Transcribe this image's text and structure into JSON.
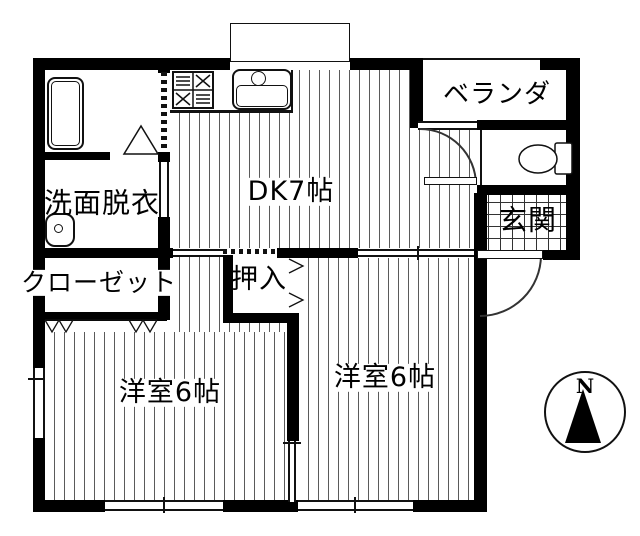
{
  "title": "2DK apartment floor plan",
  "colors": {
    "wall": "#000000",
    "line": "#333333",
    "floor_stripe": "#5a5a5a",
    "background": "#ffffff"
  },
  "rooms": {
    "dk": {
      "label": "DK7帖"
    },
    "veranda": {
      "label": "ベランダ"
    },
    "genkan": {
      "label": "玄関"
    },
    "washroom": {
      "label": "洗面脱衣"
    },
    "closet": {
      "label": "クローゼット"
    },
    "oshiire": {
      "label": "押入"
    },
    "bedroom1": {
      "label": "洋室6帖"
    },
    "bedroom2": {
      "label": "洋室6帖"
    }
  },
  "compass": {
    "north_label": "N"
  },
  "icons": {
    "bathtub": "bathtub-icon",
    "stove": "stove-icon",
    "kitchen_sink": "kitchen-sink-icon",
    "washbasin": "washbasin-icon",
    "toilet": "toilet-icon",
    "bay_window": "bay-window",
    "entry_door_arc": "door-swing-arc",
    "dk_door_arc": "door-swing-arc",
    "closet_folding_door": "folding-door-zigzag",
    "bath_door": "triangle-door"
  }
}
